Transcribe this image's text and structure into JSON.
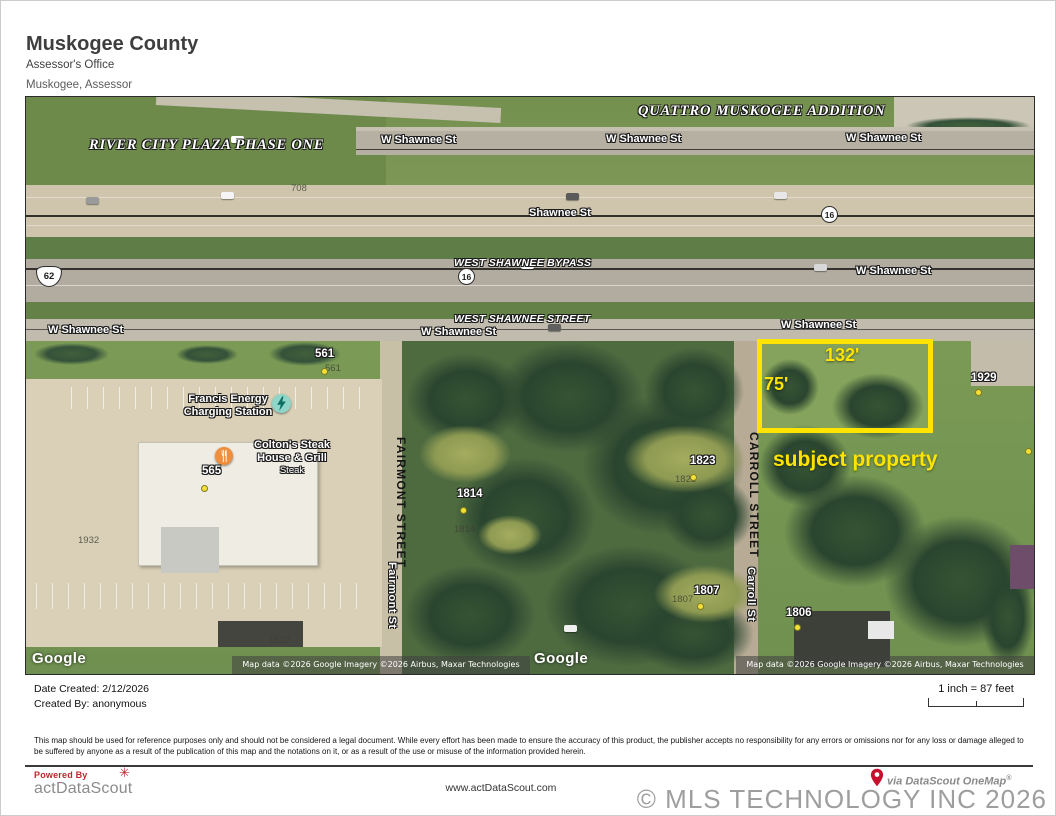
{
  "header": {
    "county": "Muskogee County",
    "office": "Assessor's Office",
    "department": "Muskogee, Assessor"
  },
  "map": {
    "subdivision_labels": {
      "river_city": "RIVER CITY PLAZA PHASE ONE",
      "quattro": "QUATTRO MUSKOGEE ADDITION"
    },
    "street_labels": {
      "w_shawnee_st": "W Shawnee St",
      "shawnee_st": "Shawnee St",
      "west_shawnee_bypass": "WEST SHAWNEE BYPASS",
      "west_shawnee_street": "WEST SHAWNEE STREET",
      "fairmont_street": "FAIRMONT STREET",
      "fairmont_st": "Fairmont St",
      "carroll_street": "CARROLL STREET",
      "carroll_st": "Carroll St"
    },
    "route_shields": {
      "us_62": "62",
      "ok_16": "16"
    },
    "pois": {
      "francis_energy": {
        "line1": "Francis Energy",
        "line2": "Charging Station"
      },
      "coltons": {
        "line1": "Colton's Steak",
        "line2": "House & Grill",
        "line3": "Steak"
      }
    },
    "parcel_numbers": {
      "p708": "708",
      "p561": "561",
      "p565": "565",
      "p1932": "1932",
      "p1814": "1814",
      "p1823": "1823",
      "p1807": "1807",
      "p1806": "1806",
      "p1812": "1812",
      "p1929": "1929"
    },
    "subject_property": {
      "frontage": "132'",
      "depth": "75'",
      "caption": "subject property"
    },
    "google_logo": "Google",
    "attribution": "Map data ©2026 Google Imagery ©2026 Airbus, Maxar Technologies"
  },
  "footer": {
    "date_created": "Date Created: 2/12/2026",
    "created_by": "Created By:  anonymous",
    "scale": "1 inch = 87 feet",
    "disclaimer": "This map should be used for reference purposes only and should not be considered a legal document.  While every effort has been made to ensure the accuracy of this product, the publisher accepts no responsibility for any errors or omissions nor for any loss or damage alleged to be suffered by anyone as a result of the publication of this map and the notations on it, or as a result of the use or misuse of the information provided herein.",
    "powered_by": "Powered By",
    "brand": "actDataScout",
    "flower_icon_glyph": "✳",
    "website": "www.actDataScout.com",
    "via": "via DataScout OneMap",
    "reg": "®",
    "copyright": "© MLS TECHNOLOGY INC 2026"
  },
  "colors": {
    "annotation_yellow": "#ffe400",
    "parcel_dot_yellow": "#f3e139",
    "brand_red": "#c0272d",
    "copyright_gray": "#9e9e9e",
    "charging_icon_teal": "#8fd8cc",
    "restaurant_icon_orange": "#ef8f3e"
  }
}
